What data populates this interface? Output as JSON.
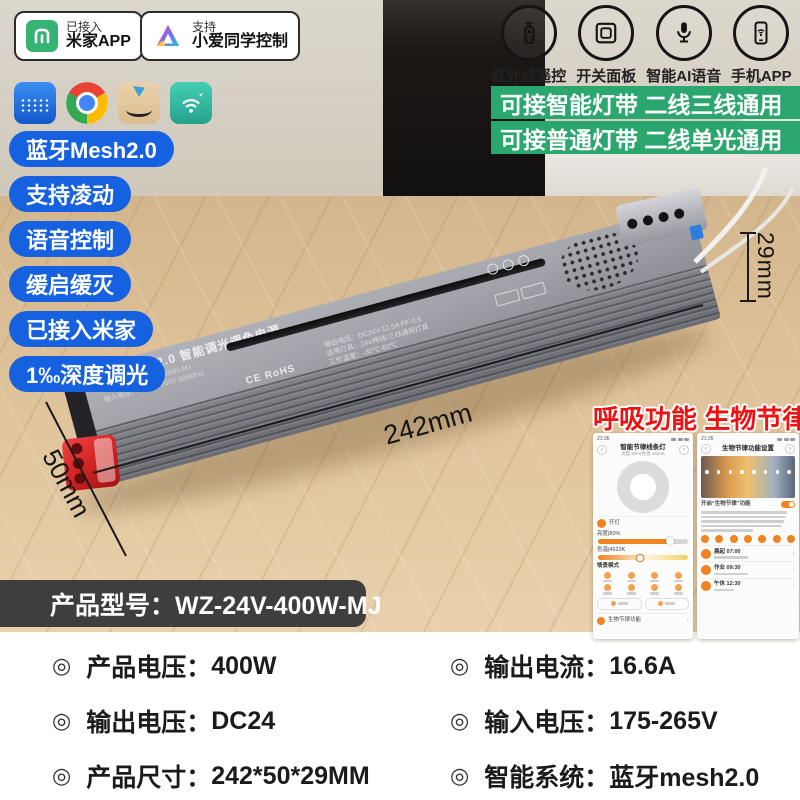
{
  "badges": [
    {
      "icon": "mijia-icon",
      "line1": "已接入",
      "line2": "米家APP"
    },
    {
      "icon": "xiaoai-icon",
      "line1": "支持",
      "line2": "小爱同学控制"
    }
  ],
  "feature_icons": [
    {
      "icon": "ir-remote-icon",
      "label": "红外线遥控"
    },
    {
      "icon": "switch-panel-icon",
      "label": "开关面板"
    },
    {
      "icon": "ai-voice-icon",
      "label": "智能AI语音"
    },
    {
      "icon": "phone-app-icon",
      "label": "手机APP"
    }
  ],
  "green_banners": [
    "可接智能灯带 二线三线通用",
    "可接普通灯带 二线单光通用"
  ],
  "blue_pills": [
    "蓝牙Mesh2.0",
    "支持凌动",
    "语音控制",
    "缓启缓灭",
    "已接入米家",
    "1‰深度调光"
  ],
  "device_label": {
    "title": "蓝牙Mesh2.0 智能调光调色电源",
    "model": "产品型号：WZ-24V-400W-MJ",
    "input": "输入电压：AC175-265V 50/60Hz",
    "output": "输出电压：DC24V-12.5A PF-0.5",
    "fixture": "适用灯具：24V两线/三线通用灯具",
    "temp": "工作温度：-30℃-60℃",
    "cert": "CE RoHS"
  },
  "dimensions": {
    "length": "242mm",
    "depth": "50mm",
    "height": "29mm"
  },
  "headline": "呼吸功能 生物节律",
  "phone_left": {
    "time": "21:36",
    "title": "智能节律线条灯",
    "subtitle": "亮度 80%|色温 4622K",
    "power": "开灯",
    "brightness": "亮度|80%",
    "cct": "色温|4622K",
    "scenes": "情景模式",
    "footer": "生物节律功能"
  },
  "phone_right": {
    "time": "21:35",
    "title": "生物节律功能设置",
    "toggle": "开启“生物节律”功能",
    "items": [
      "晨起 07:00",
      "作业 09:30",
      "午休 12:30"
    ]
  },
  "model_banner": "产品型号：WZ-24V-400W-MJ",
  "specs_left": [
    {
      "label": "产品电压：",
      "value": "400W"
    },
    {
      "label": "输出电压：",
      "value": "DC24"
    },
    {
      "label": "产品尺寸：",
      "value": "242*50*29MM"
    }
  ],
  "specs_right": [
    {
      "label": "输出电流：",
      "value": "16.6A"
    },
    {
      "label": "输入电压：",
      "value": "175-265V"
    },
    {
      "label": "智能系统：",
      "value": "蓝牙mesh2.0"
    }
  ],
  "ui": {
    "bullet": "◎",
    "chevron_left": "‹",
    "chevron_right": "›"
  },
  "colors": {
    "pill_blue": "#1661e0",
    "banner_green": "#2aa66e",
    "headline_red": "#ee1111",
    "model_bar_gray": "#3f3e3e",
    "accent_orange": "#f08420",
    "mijia_green": "#35b372"
  }
}
